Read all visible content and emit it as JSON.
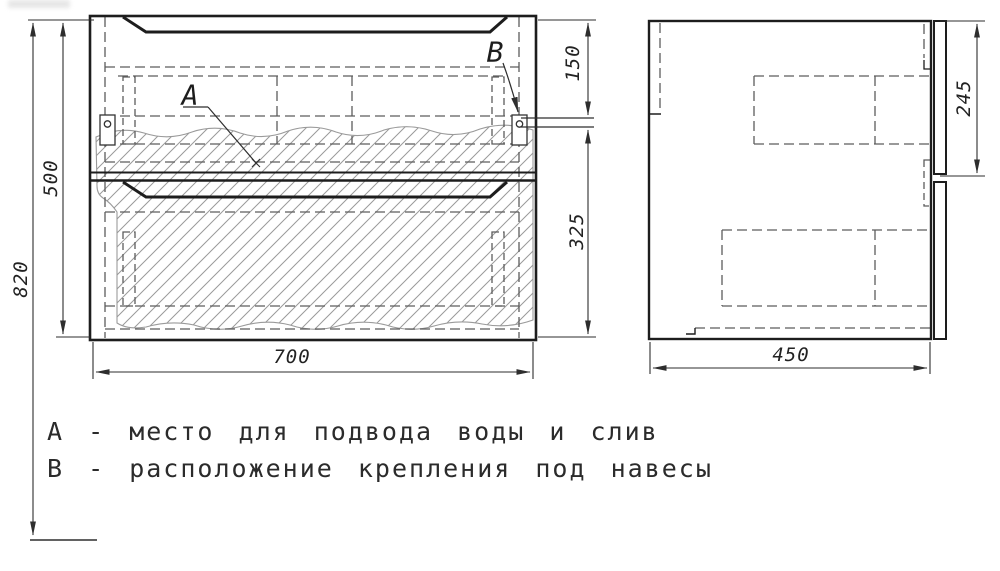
{
  "drawing": {
    "type": "technical-drawing",
    "views": [
      "front",
      "side"
    ],
    "callouts": {
      "a": "А",
      "b": "В"
    },
    "dimensions": {
      "overall_height": "820",
      "cabinet_height": "500",
      "cabinet_width": "700",
      "top_to_mount": "150",
      "mount_to_bottom": "325",
      "side_top_segment": "245",
      "cabinet_depth": "450"
    },
    "legend": {
      "line_a": "А - место для подвода воды и слив",
      "line_b": "В - расположение крепления под навесы"
    },
    "colors": {
      "background": "#ffffff",
      "solid_line": "#1d1d1d",
      "hidden_line": "#5c5c5c",
      "hatch_line": "#9a9a9a",
      "dimension_line": "#2e2e2e",
      "text": "#222222"
    }
  }
}
